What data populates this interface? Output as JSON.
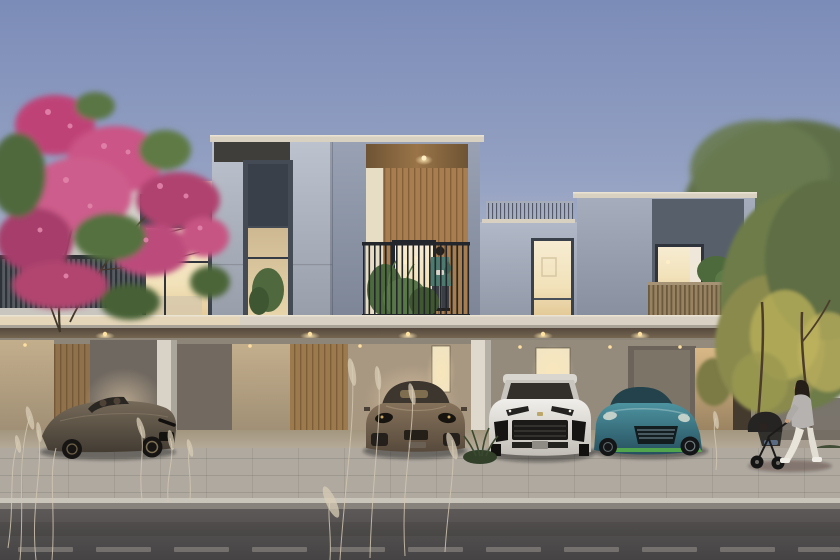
{
  "meta": {
    "type": "architectural-render-photo",
    "description": "Dusk exterior render of a modern two-storey townhouse row with lit interiors, four luxury cars parked in open carports, a man on a central balcony, a pink flowering tree on the left and a woman pushing a stroller on the right sidewalk",
    "time_of_day": "dusk"
  },
  "palette": {
    "sky_top": "#7b8cb8",
    "sky_mid": "#b3bacb",
    "sky_horizon": "#dbcfc6",
    "wall_white": "#ddd9d2",
    "tower_light": "#bdc3ce",
    "tower_dark": "#99a2b4",
    "recess_wall": "#b1b9c8",
    "tower_right": "#a6aebe",
    "panel_dark": "#575f6b",
    "cap": "#d8d0c1",
    "soffit_dark": "#5e564c",
    "wood": "#a87e50",
    "window_glow": "#f6e7c4",
    "railing_dark": "#23272b",
    "slab_face": "#d8d1c4",
    "garage_warm": "#b49f7e",
    "garage_dim": "#8d8578",
    "column": "#d8d2c7",
    "sidewalk": "#afa9a0",
    "road": "#565354",
    "car1_body": "#6b6052",
    "car2_body": "#7e6b56",
    "car3_body": "#eceae6",
    "car4_body": "#448691",
    "car4_accent": "#54ad4b",
    "tree_pink": "#cb5586",
    "tree_green": "#55713f",
    "trees_right": "#5f7048",
    "trees_lit": "#b3ab58",
    "shirt_teal": "#4c7a6e",
    "jacket_grey": "#b6b2af",
    "grass_dry": "#d3c7b0"
  },
  "scene": {
    "sky": {
      "description": "clear dusk gradient, blue above fading to warm pale at horizon"
    },
    "building": {
      "style": "modern flat-roof townhouses, grey and white volumes with wood accents",
      "floors": 2,
      "left_unit": {
        "window": "large lit living-room window with chandelier",
        "balcony_railing": "dark vertical metal slats",
        "second_window": "dark framed window with indoor plant"
      },
      "central_tower": {
        "cladding": "wood slat recess",
        "balcony": "dark railing with potted plants",
        "occupant": "man standing looking at phone",
        "ceiling_light": "warm downlight"
      },
      "middle_recess": {
        "roof_railing": "thin slat guardrail",
        "window": "tall lit window"
      },
      "right_unit": {
        "panel": "dark grey recessed panel",
        "window": "lit bedroom window with curtain",
        "balcony_railing": "wood slats",
        "plant": "potted shrub"
      },
      "carport": {
        "columns": 3,
        "lit_door_panels": 2,
        "cladding": "warm wood slat garage doors",
        "downlights": 6
      }
    },
    "cars": [
      {
        "name": "bronze convertible grand tourer",
        "color": "dark bronze"
      },
      {
        "name": "porsche panamera saloon",
        "color": "bronze brown"
      },
      {
        "name": "lamborghini urus suv",
        "color": "white"
      },
      {
        "name": "aston martin coupe",
        "color": "teal with lime accents"
      }
    ],
    "people": [
      {
        "name": "man on balcony",
        "clothing": "teal shirt, dark trousers"
      },
      {
        "name": "woman pushing stroller",
        "clothing": "grey jacket, white trousers, white sneakers"
      },
      {
        "name": "child in stroller"
      }
    ],
    "street": {
      "sidewalk": "light stone pavers",
      "curb": "pale stone",
      "road": "dark asphalt with faded dashed lane line"
    },
    "vegetation": {
      "left_tree": "pink flowering crape myrtle overhanging the balcony",
      "right_trees": "green trees, warm uplighting at right garden",
      "foreground": "dry wispy grasses and a green tuft on the sidewalk"
    }
  }
}
